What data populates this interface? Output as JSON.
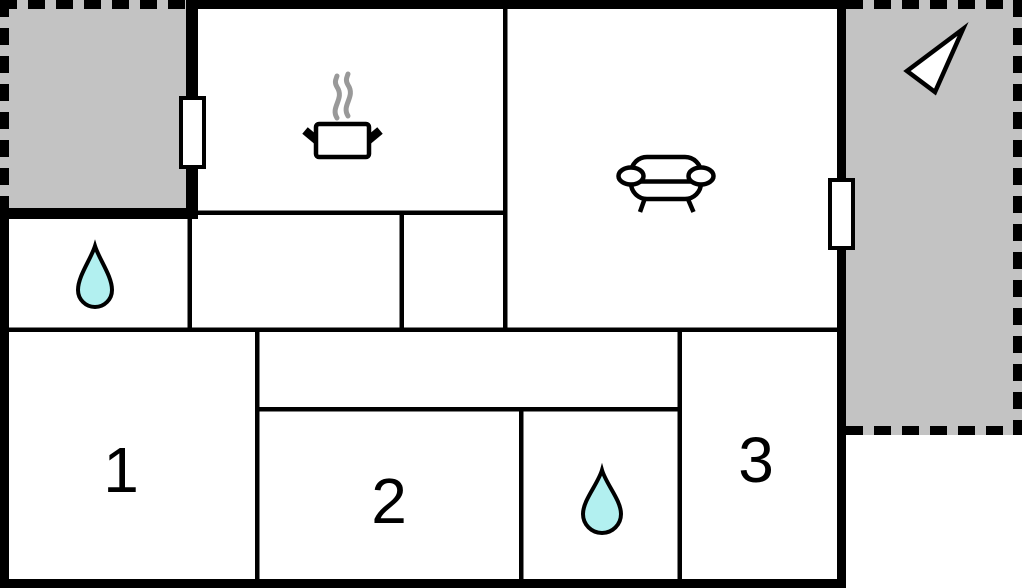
{
  "floorplan": {
    "colors": {
      "background": "#ffffff",
      "wall": "#000000",
      "terrace": "#c3c3c3",
      "water_drop": "#b2f0f0",
      "steam": "#999999",
      "door_fill": "#ffffff"
    },
    "rooms": [
      {
        "id": "bedroom-1",
        "label": "1"
      },
      {
        "id": "bedroom-2",
        "label": "2"
      },
      {
        "id": "bedroom-3",
        "label": "3"
      }
    ],
    "icons": {
      "kitchen": "cooking-pot-icon",
      "living_room": "sofa-icon",
      "bathroom_upper": "water-drop-icon",
      "bathroom_lower": "water-drop-icon",
      "terrace_right": "direction-arrow-icon"
    }
  }
}
